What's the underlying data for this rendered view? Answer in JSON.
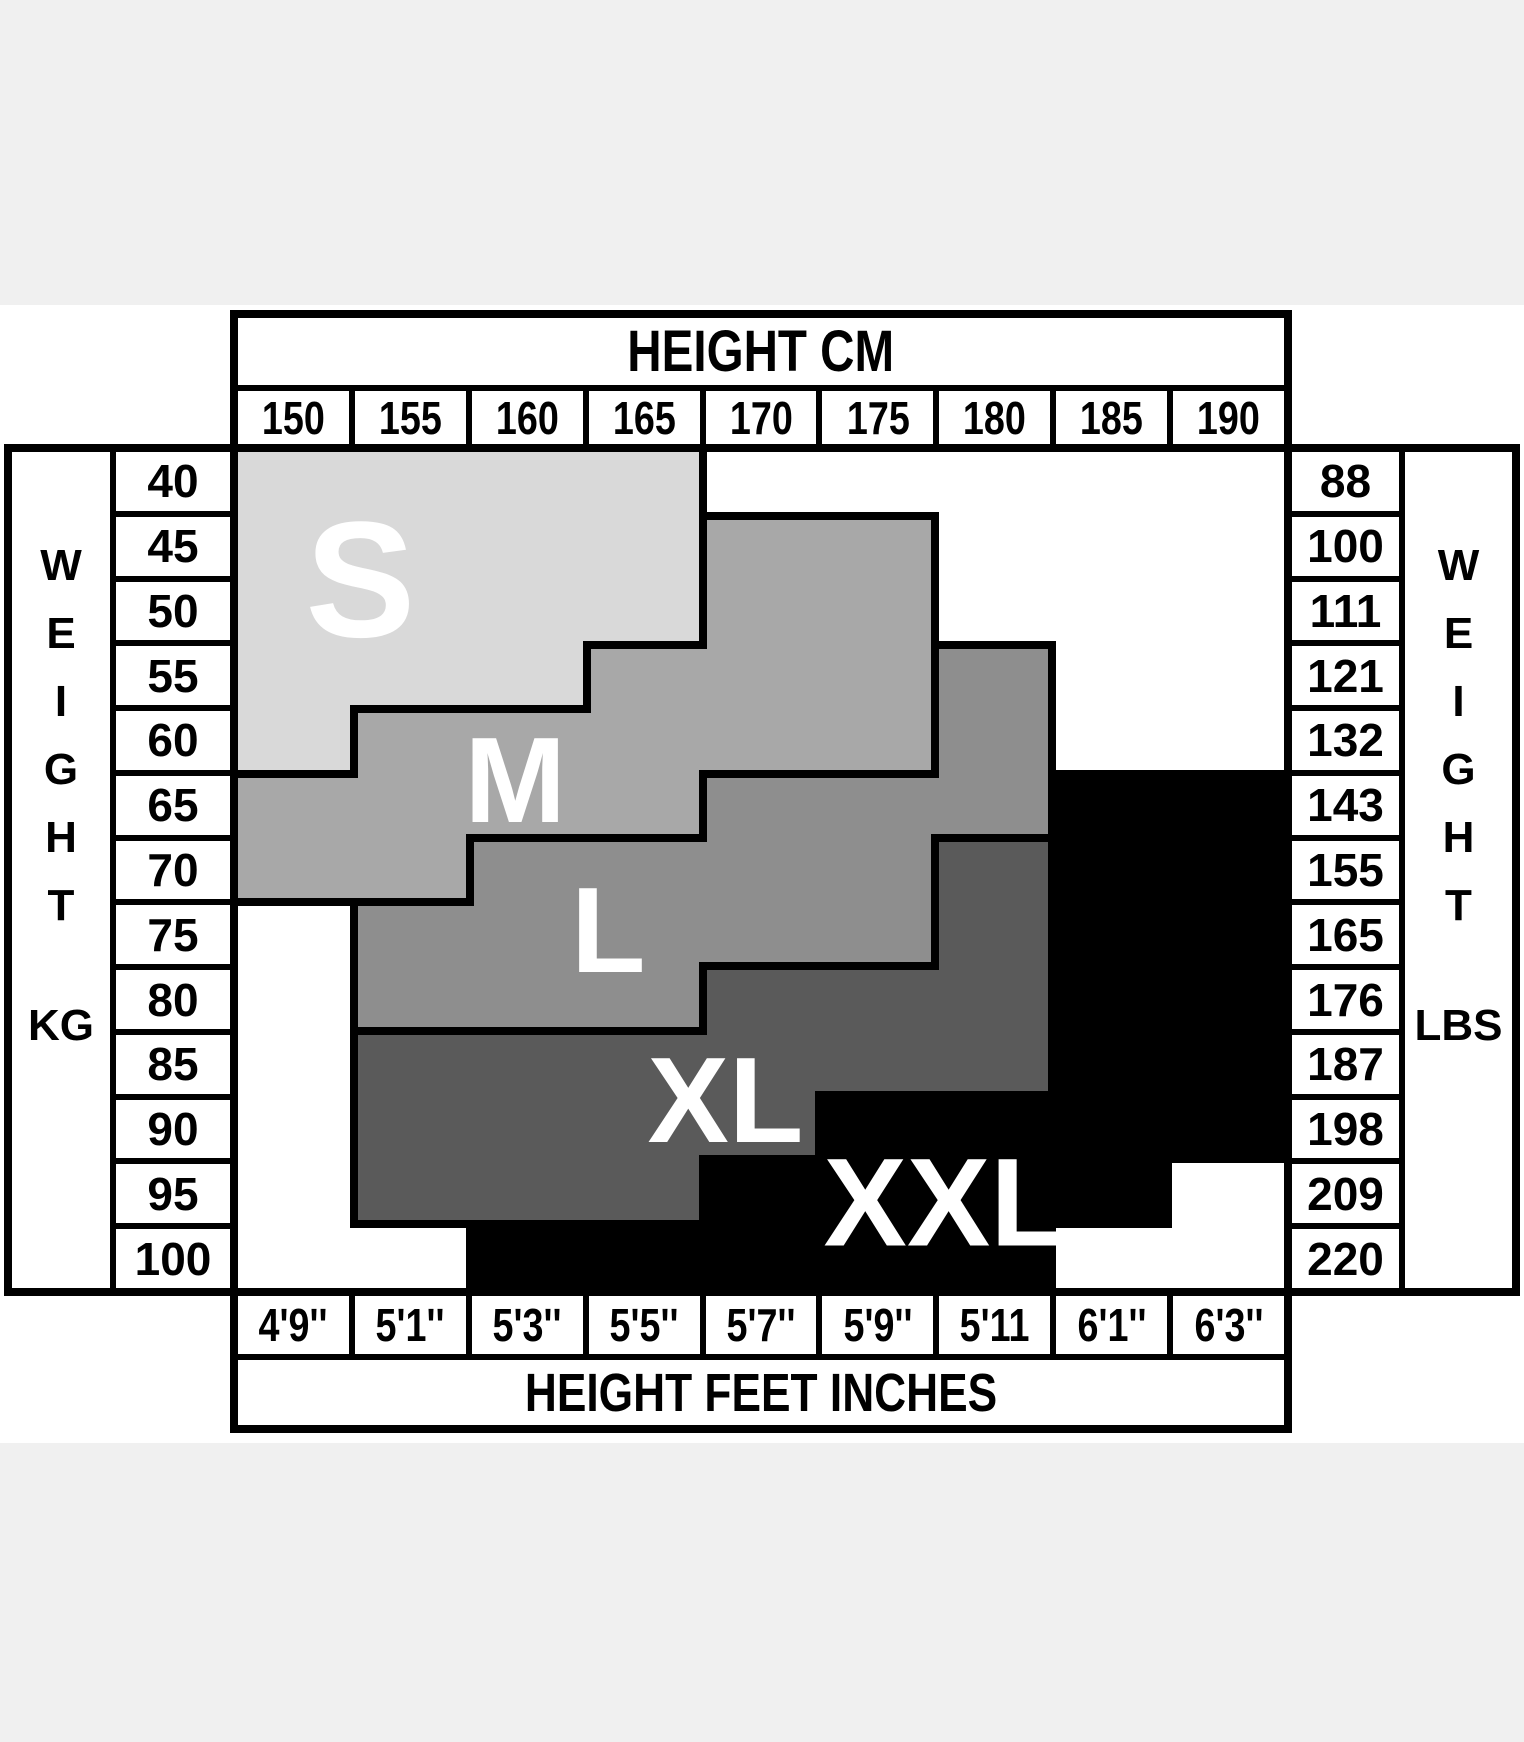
{
  "chart_data": {
    "type": "heatmap",
    "title_top": "HEIGHT CM",
    "title_bottom": "HEIGHT FEET INCHES",
    "x_axis_top": {
      "label": "HEIGHT CM",
      "values": [
        "150",
        "155",
        "160",
        "165",
        "170",
        "175",
        "180",
        "185",
        "190"
      ]
    },
    "x_axis_bottom": {
      "label": "HEIGHT FEET INCHES",
      "values": [
        "4'9''",
        "5'1''",
        "5'3''",
        "5'5''",
        "5'7''",
        "5'9''",
        "5'11",
        "6'1''",
        "6'3''"
      ]
    },
    "y_axis_left": {
      "label": "WEIGHT",
      "letters": [
        "W",
        "E",
        "I",
        "G",
        "H",
        "T"
      ],
      "unit": "KG",
      "values": [
        "40",
        "45",
        "50",
        "55",
        "60",
        "65",
        "70",
        "75",
        "80",
        "85",
        "90",
        "95",
        "100"
      ]
    },
    "y_axis_right": {
      "label": "WEIGHT",
      "letters": [
        "W",
        "E",
        "I",
        "G",
        "H",
        "T"
      ],
      "unit": "LBS",
      "values": [
        "88",
        "100",
        "111",
        "121",
        "132",
        "143",
        "155",
        "165",
        "176",
        "187",
        "198",
        "209",
        "220"
      ]
    },
    "sizes": [
      {
        "code": "S",
        "label": "S",
        "color": "#d9d9d9",
        "label_x": 11.7,
        "label_y": 15.3,
        "label_size": 165
      },
      {
        "code": "M",
        "label": "M",
        "color": "#a8a8a8",
        "label_x": 26.5,
        "label_y": 39.2,
        "label_size": 122
      },
      {
        "code": "L",
        "label": "L",
        "color": "#8e8e8e",
        "label_x": 35.4,
        "label_y": 57.2,
        "label_size": 122
      },
      {
        "code": "X",
        "label": "XL",
        "color": "#5a5a5a",
        "label_x": 46.6,
        "label_y": 77.5,
        "label_size": 122
      },
      {
        "code": "Z",
        "label": "XXL",
        "color": "#000000",
        "label_x": 67.6,
        "label_y": 89.8,
        "label_size": 125
      }
    ],
    "cell_map": [
      "SSSS.....",
      "SSSSMM...",
      "SSSSMM...",
      "SSSMMML..",
      "SMMMMML..",
      "MMMMLLLZZ",
      "MMLLLLXZZ",
      ".LLLLLXZZ",
      ".LLLXXXZZ",
      ".XXXXXXZZ",
      ".XXXXZZZZ",
      ".XXXZZZZ.",
      "..ZZZZZ.."
    ],
    "grid": {
      "columns": 9,
      "rows": 13,
      "border_color": "#000000",
      "border_px": 8
    },
    "background_band_color": "#f0f0f0"
  }
}
